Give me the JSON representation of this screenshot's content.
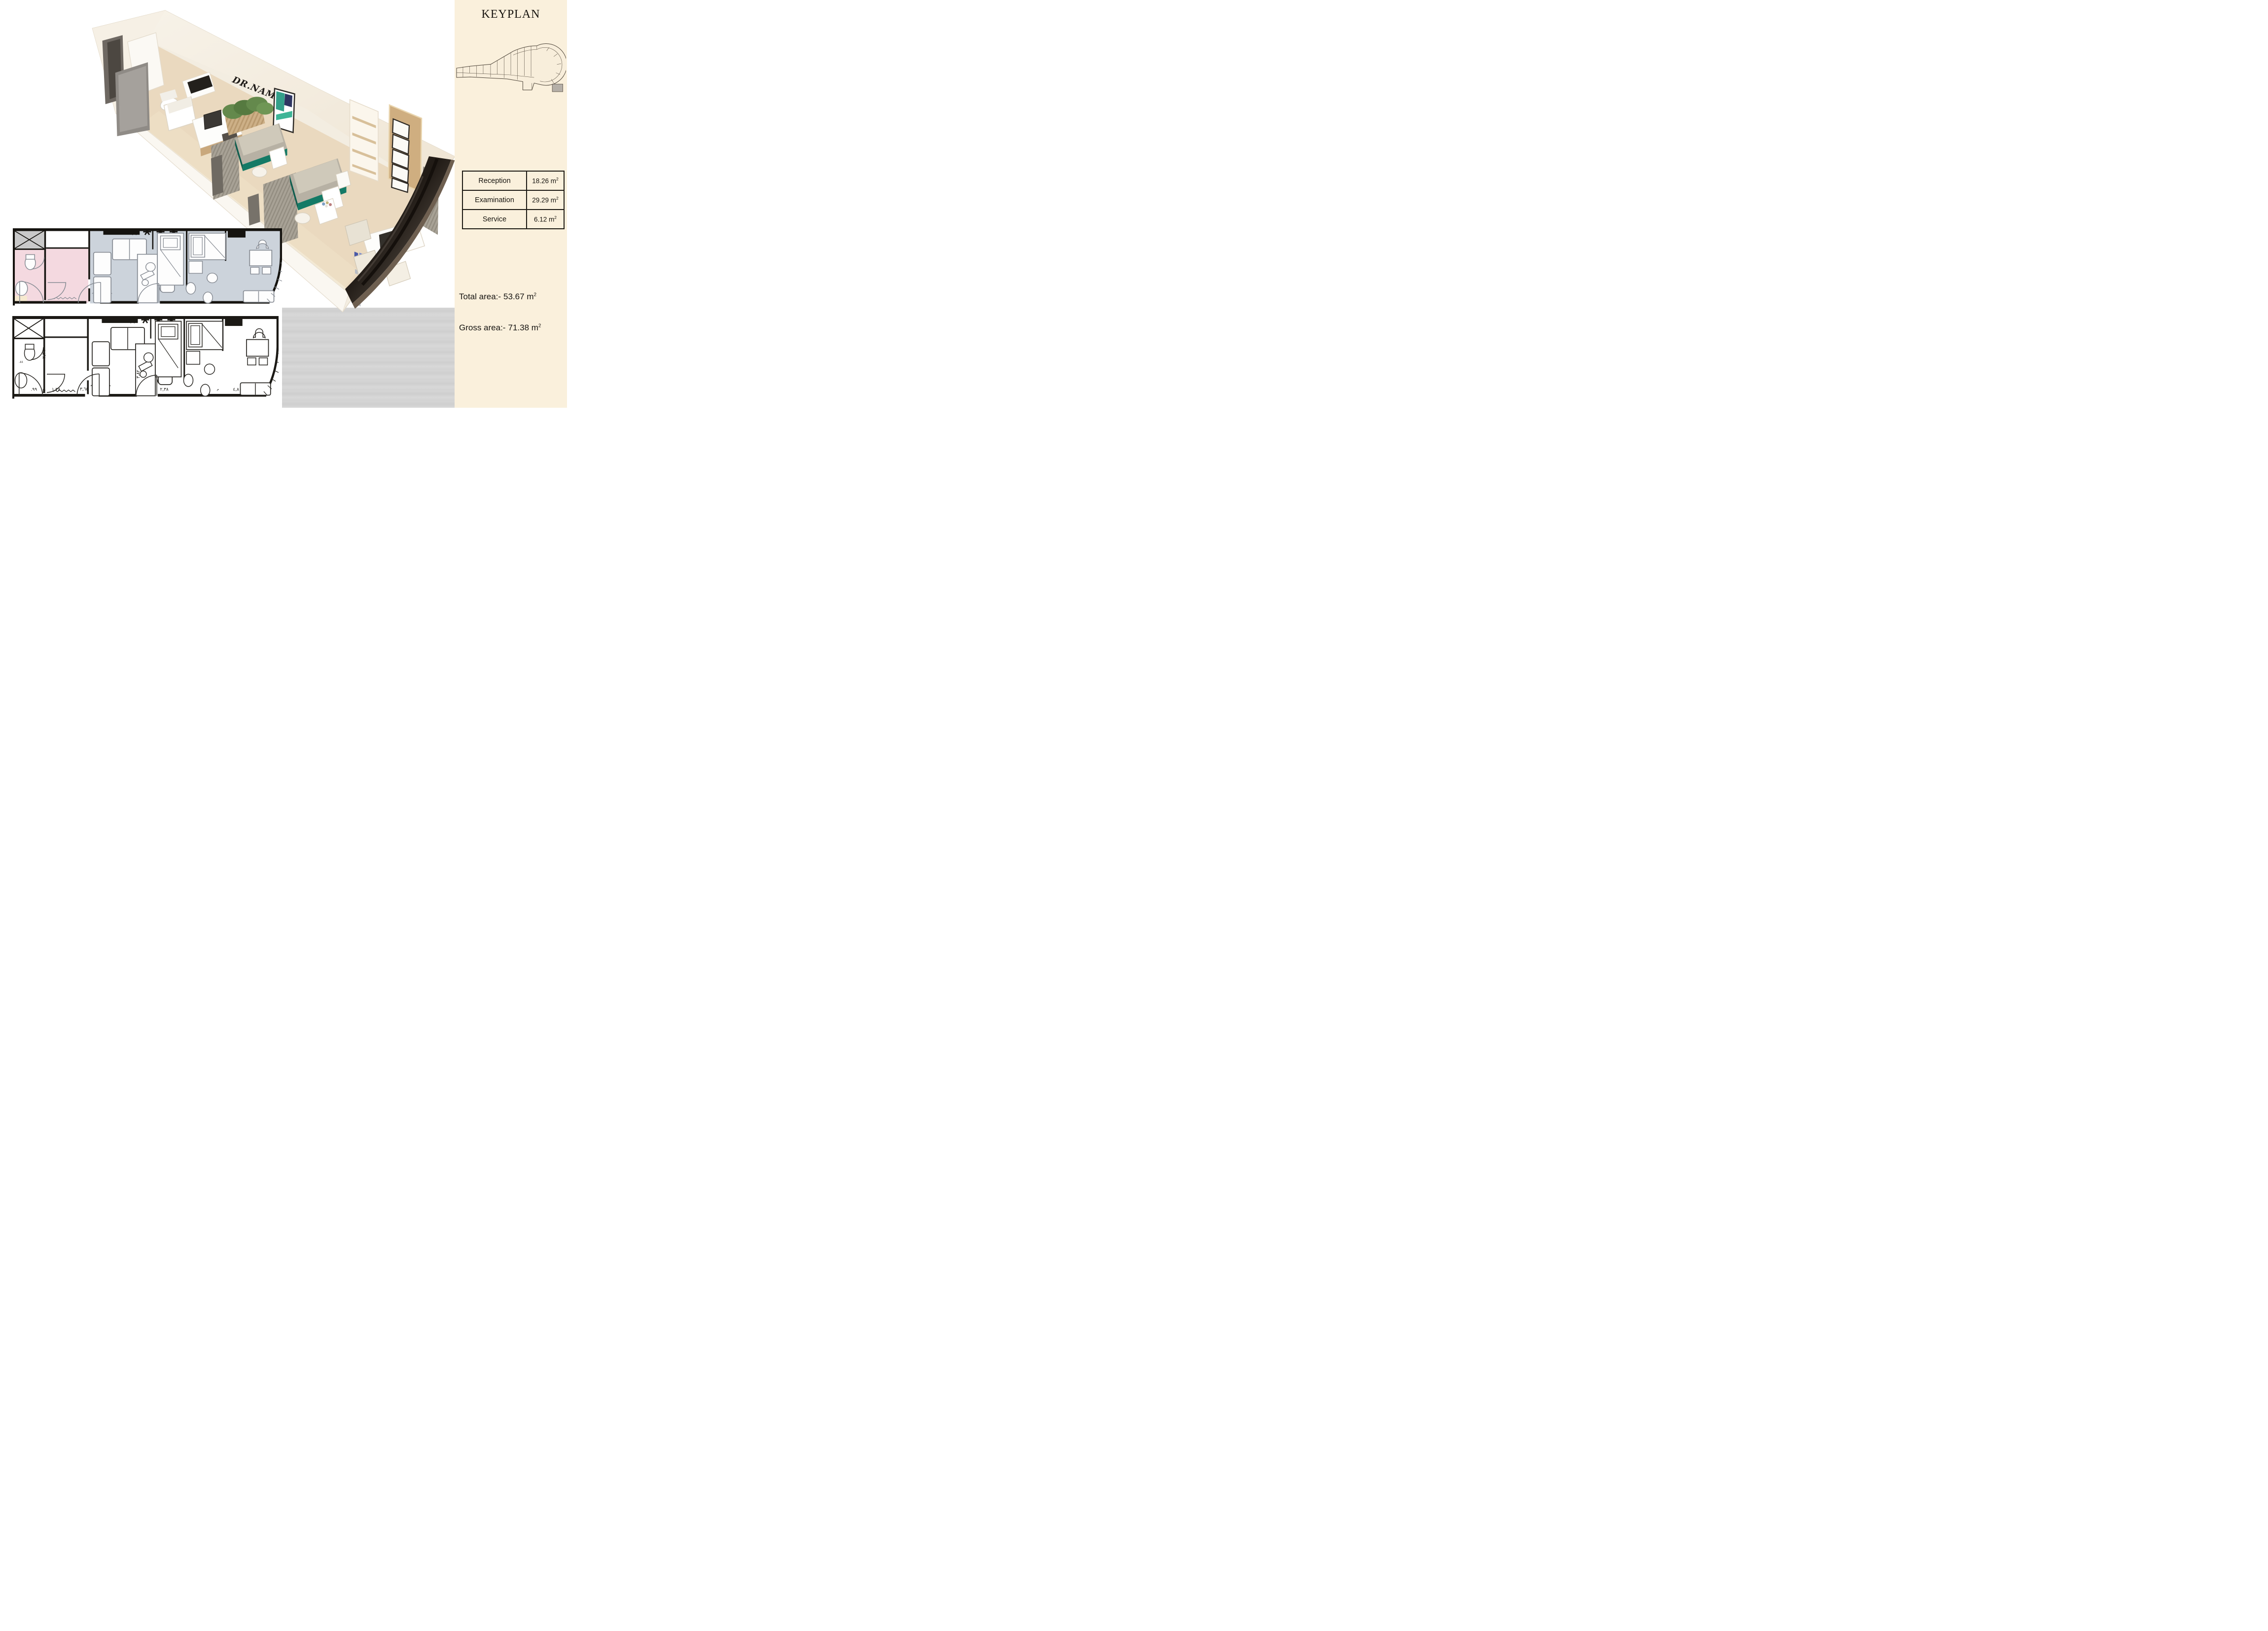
{
  "sidebar": {
    "bg_color": "#faf0dc",
    "keyplan_title": "KEYPLAN",
    "table": {
      "unit": " m",
      "sup": "2",
      "rows": [
        {
          "label": "Reception",
          "area": "18.26"
        },
        {
          "label": "Examination",
          "area": "29.29"
        },
        {
          "label": "Service",
          "area": "6.12"
        }
      ]
    },
    "totals": [
      {
        "label": "Total area:-",
        "value": "53.67",
        "unit": " m",
        "sup": "2"
      },
      {
        "label": "Gross area:-",
        "value": "71.38",
        "unit": " m",
        "sup": "2"
      }
    ]
  },
  "render": {
    "wall_sign": "DR.NAME",
    "colors": {
      "floor": "#e9d9c0",
      "wall": "#f4eee2",
      "exam_bed_accent": "#147a66",
      "partition": "#a49e92",
      "window_glass": "#241d18",
      "wood_panel": "#c9a87c",
      "plant_green": "#64894c"
    }
  },
  "plans": {
    "colored": {
      "room_colors": {
        "bathroom_pink": "#f4d9e0",
        "clinic_blue_gray": "#ccd3db",
        "shower_gray": "#c9c9c9"
      }
    },
    "dims": [
      {
        "t": "٢,٣٩"
      },
      {
        "t": ".٤٤"
      },
      {
        "t": ".٩٩"
      },
      {
        "t": "١,٣٨"
      },
      {
        "t": "٣,٦٥"
      },
      {
        "t": "٢,٣٨"
      },
      {
        "t": "م"
      },
      {
        "t": "٤,٨٠"
      },
      {
        "t": "٣,٨٢"
      },
      {
        "t": "١,٣٢"
      }
    ]
  }
}
